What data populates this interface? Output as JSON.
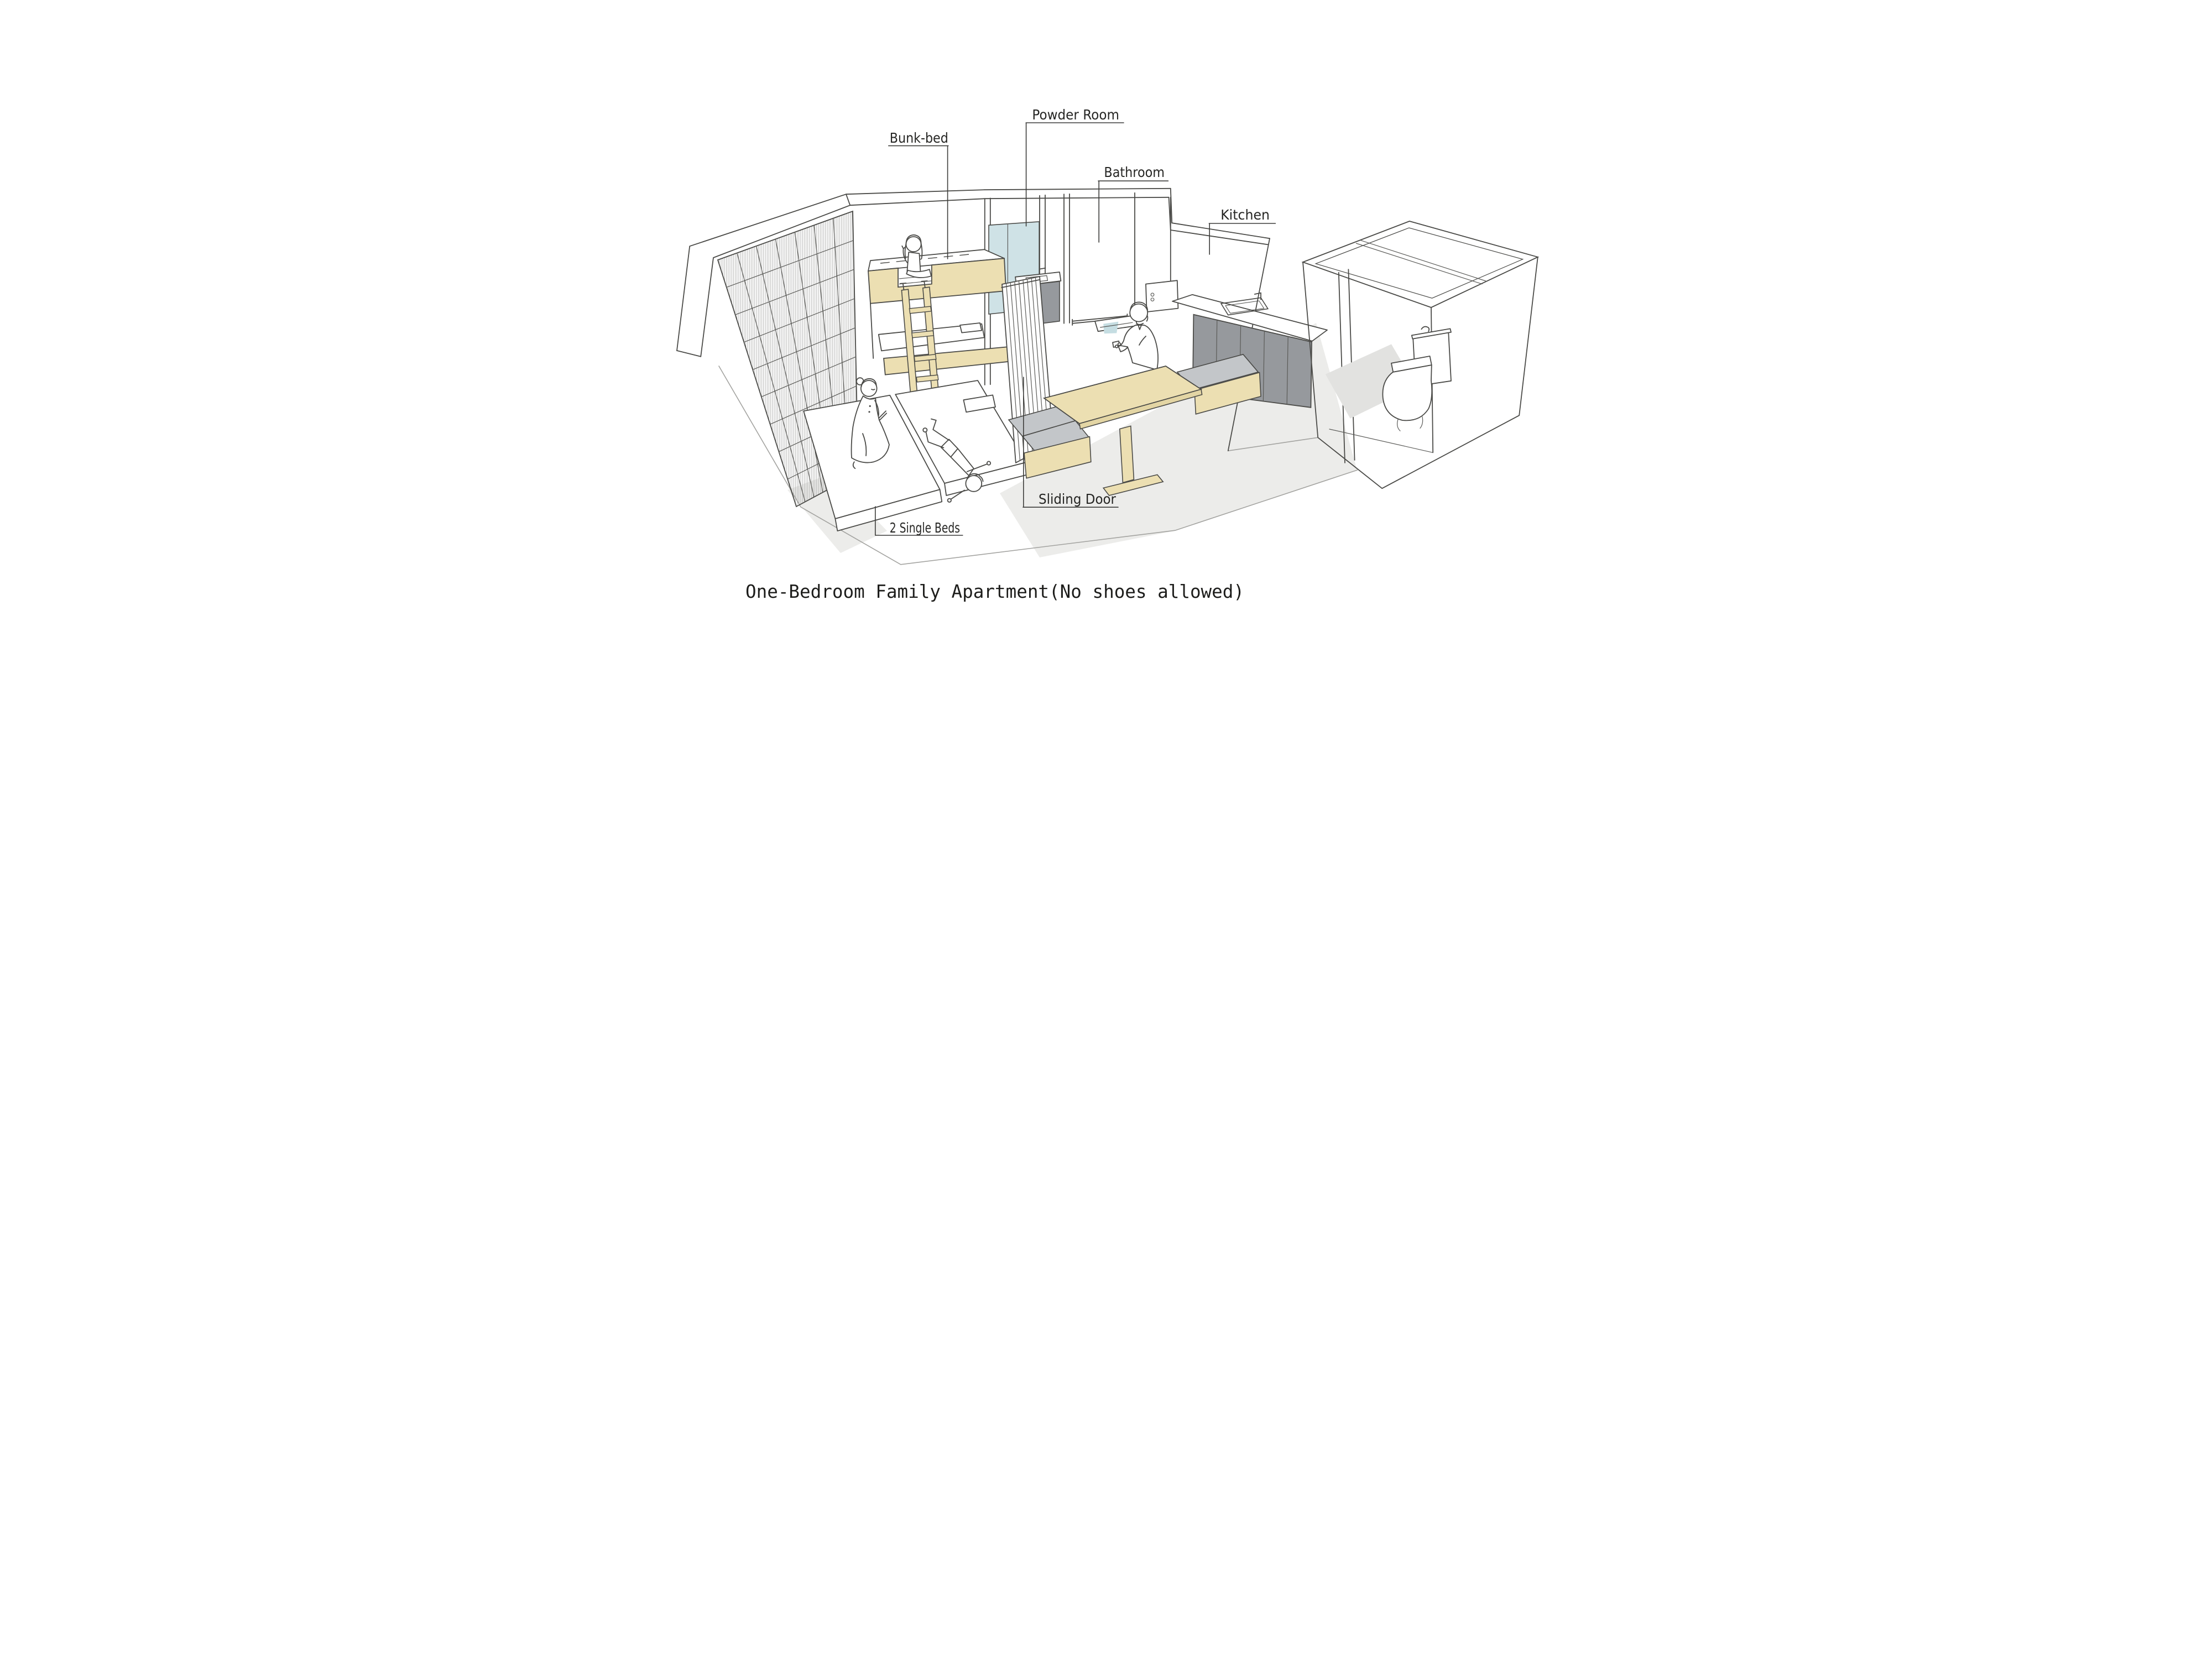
{
  "title": "One-Bedroom Family Apartment(No shoes allowed)",
  "labels": {
    "bunk_bed": "Bunk-bed",
    "powder_room": "Powder Room",
    "bathroom": "Bathroom",
    "kitchen": "Kitchen",
    "sliding_door": "Sliding Door",
    "single_beds": "2 Single Beds"
  },
  "illustration": {
    "style": "hand-drawn isometric apartment sketch",
    "figures": [
      "girl-sitting-on-bunk-bed",
      "mother-kneeling-on-bed",
      "child-lying-on-bed",
      "man-sitting-at-dining-table"
    ],
    "furniture": [
      "bunk-bed-with-ladder",
      "two-single-beds",
      "sliding-door-partition",
      "powder-room-vanity-with-mirror",
      "bathtub",
      "dining-table-with-benches",
      "kitchen-counter-with-sink",
      "toilet-room-with-toilet",
      "gridded-window-wall"
    ]
  },
  "colors": {
    "line": "#4a4a47",
    "annotation": "#3c3c3a",
    "wood": "#ecdfb2",
    "wood_edge": "#e3d5a4",
    "cushion": "#c3c6c9",
    "cabinet": "#96999d",
    "glass": "#cfe2e6",
    "water": "#c5dde2",
    "floor": "#ececea",
    "floor_dark": "#e2e2e0",
    "paper": "#ffffff"
  }
}
